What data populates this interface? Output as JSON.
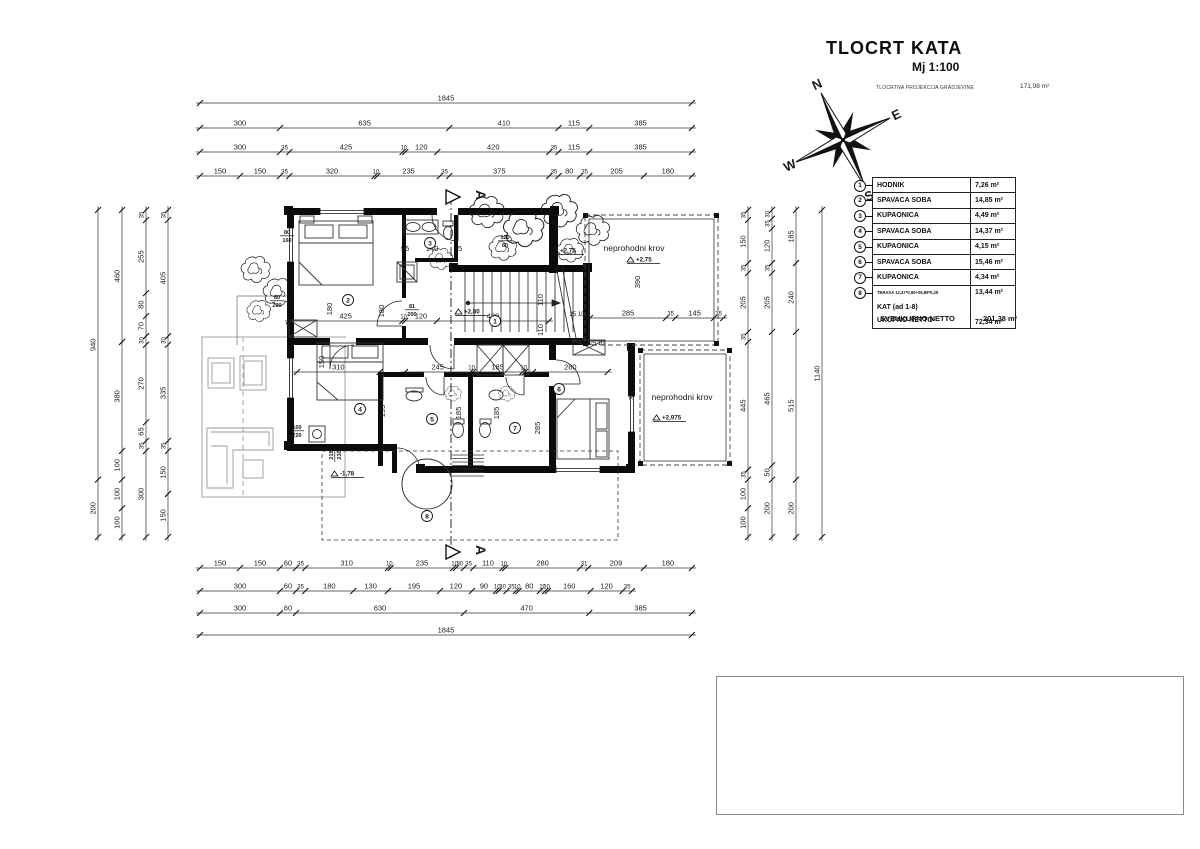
{
  "title_block": {
    "title": "TLOCRT KATA",
    "scale": "Mj 1:100",
    "projection_label": "TLOCRTNA PROJEKCIJA GRADJEVINE",
    "projection_value": "171,98 m²"
  },
  "compass": {
    "n": "N",
    "e": "E",
    "s": "S",
    "w": "W"
  },
  "legend": {
    "rows": [
      {
        "num": "1",
        "label": "HODNIK",
        "value": "7,26 m²",
        "small": false
      },
      {
        "num": "2",
        "label": "SPAVAĆA SOBA",
        "value": "14,85 m²",
        "small": false
      },
      {
        "num": "3",
        "label": "KUPAONICA",
        "value": "4,49 m²",
        "small": false
      },
      {
        "num": "4",
        "label": "SPAVAĆA SOBA",
        "value": "14,37 m²",
        "small": false
      },
      {
        "num": "5",
        "label": "KUPAONICA",
        "value": "4,15 m²",
        "small": false
      },
      {
        "num": "6",
        "label": "SPAVAĆA SOBA",
        "value": "15,46 m²",
        "small": false
      },
      {
        "num": "7",
        "label": "KUPAONICA",
        "value": "4,34 m²",
        "small": false
      },
      {
        "num": "8",
        "label": "TERASA 12,47*0,50+26,89*0,25",
        "value": "13,44 m²",
        "small": true
      }
    ],
    "kat_label": "KAT (ad 1-8)",
    "ukupno_label": "UKUPNO NETTO",
    "ukupno_value": "72,34  m²",
    "total_label": "SVEUKUPNO NETTO",
    "total_value": "201,38  m²"
  },
  "plan": {
    "section_label": "A",
    "roof_label_1": "neprohodni krov",
    "roof_label_2": "neprohodni krov",
    "dim_chains": [
      {
        "dir": "h",
        "x": 200,
        "y": 103,
        "scale": 0.2666,
        "segs": [
          "1845"
        ]
      },
      {
        "dir": "h",
        "x": 200,
        "y": 128,
        "scale": 0.2666,
        "segs": [
          "300",
          "635",
          "410",
          "115",
          "385"
        ]
      },
      {
        "dir": "h",
        "x": 200,
        "y": 152,
        "scale": 0.2666,
        "segs": [
          "300",
          "35",
          "425",
          "10",
          "120",
          "420",
          "35",
          "115",
          "385"
        ]
      },
      {
        "dir": "h",
        "x": 200,
        "y": 176,
        "scale": 0.2666,
        "segs": [
          "150",
          "150",
          "35",
          "320",
          "10",
          "235",
          "35",
          "375",
          "35",
          "80",
          "35",
          "205",
          "180"
        ]
      },
      {
        "dir": "h",
        "x": 200,
        "y": 568,
        "scale": 0.2666,
        "segs": [
          "150",
          "150",
          "60",
          "35",
          "310",
          "10",
          "235",
          "10",
          "30",
          "35",
          "110",
          "10",
          "280",
          "31",
          "209",
          "180"
        ]
      },
      {
        "dir": "h",
        "x": 200,
        "y": 591,
        "scale": 0.2666,
        "segs": [
          "300",
          "60",
          "35",
          "180",
          "130",
          "195",
          "120",
          "90",
          "10",
          "30",
          "35",
          "10",
          "80",
          "20",
          "10",
          "160",
          "120",
          "35"
        ]
      },
      {
        "dir": "h",
        "x": 200,
        "y": 613,
        "scale": 0.2666,
        "segs": [
          "300",
          "60",
          "630",
          "470",
          "385"
        ]
      },
      {
        "dir": "h",
        "x": 200,
        "y": 635,
        "scale": 0.2666,
        "segs": [
          "1845"
        ]
      },
      {
        "dir": "v",
        "x": 98,
        "y": 210,
        "scale": 0.2868,
        "segs": [
          "940",
          "200"
        ]
      },
      {
        "dir": "v",
        "x": 122,
        "y": 210,
        "scale": 0.2868,
        "segs": [
          "460",
          "380",
          "100",
          "100",
          "100"
        ]
      },
      {
        "dir": "v",
        "x": 146,
        "y": 210,
        "scale": 0.2868,
        "segs": [
          "35",
          "255",
          "80",
          "70",
          "30",
          "270",
          "65",
          "35",
          "300"
        ]
      },
      {
        "dir": "v",
        "x": 168,
        "y": 210,
        "scale": 0.2868,
        "segs": [
          "35",
          "405",
          "30",
          "335",
          "35",
          "150",
          "150"
        ]
      },
      {
        "dir": "v",
        "x": 748,
        "y": 210,
        "scale": 0.2868,
        "segs": [
          "35",
          "150",
          "35",
          "205",
          "35",
          "445",
          "35",
          "100",
          "100"
        ]
      },
      {
        "dir": "v",
        "x": 772,
        "y": 210,
        "scale": 0.2868,
        "segs": [
          "30",
          "35",
          "120",
          "35",
          "205",
          "465",
          "50",
          "200"
        ]
      },
      {
        "dir": "v",
        "x": 796,
        "y": 210,
        "scale": 0.2868,
        "segs": [
          "185",
          "240",
          "515",
          "200"
        ]
      },
      {
        "dir": "v",
        "x": 822,
        "y": 210,
        "scale": 0.2868,
        "segs": [
          "1140"
        ]
      },
      {
        "dir": "h",
        "x": 289,
        "y": 321,
        "scale": 0.2666,
        "segs": [
          "425",
          "10",
          "120",
          "420"
        ]
      },
      {
        "dir": "h",
        "x": 590,
        "y": 318,
        "scale": 0.2666,
        "segs": [
          "285",
          "35",
          "145",
          "35"
        ]
      },
      {
        "dir": "h",
        "x": 297,
        "y": 372,
        "scale": 0.2666,
        "segs": [
          "310"
        ]
      },
      {
        "dir": "h",
        "x": 405,
        "y": 372,
        "scale": 0.2666,
        "segs": [
          "245",
          "10",
          "185",
          "10"
        ]
      },
      {
        "dir": "h",
        "x": 533,
        "y": 372,
        "scale": 0.2666,
        "segs": [
          "280"
        ]
      }
    ],
    "texts": [
      {
        "t": "110",
        "x": 543,
        "y": 300,
        "rot": -90
      },
      {
        "t": "110",
        "x": 543,
        "y": 330,
        "rot": -90
      },
      {
        "t": "285",
        "x": 540,
        "y": 428,
        "rot": -90
      },
      {
        "t": "185",
        "x": 461,
        "y": 413,
        "rot": -90
      },
      {
        "t": "185",
        "x": 499,
        "y": 413,
        "rot": -90
      },
      {
        "t": "195",
        "x": 385,
        "y": 411,
        "rot": -90
      },
      {
        "t": "180",
        "x": 384,
        "y": 311,
        "rot": -90
      },
      {
        "t": "180",
        "x": 332,
        "y": 309,
        "rot": -90
      },
      {
        "t": "150",
        "x": 324,
        "y": 362,
        "rot": -90
      },
      {
        "t": "390",
        "x": 640,
        "y": 282,
        "rot": -90
      },
      {
        "t": "395",
        "x": 634,
        "y": 394,
        "rot": -90
      },
      {
        "t": "95",
        "x": 405,
        "y": 251
      },
      {
        "t": "140",
        "x": 432,
        "y": 251
      },
      {
        "t": "25",
        "x": 458,
        "y": 251
      },
      {
        "t": "25 10",
        "x": 577,
        "y": 316,
        "size": 6
      },
      {
        "t": "25 10",
        "x": 597,
        "y": 345,
        "size": 6
      }
    ],
    "levels": [
      {
        "t": "+2,80",
        "x": 466,
        "y": 314
      },
      {
        "t": "+2,75",
        "x": 562,
        "y": 253
      },
      {
        "t": "+2,75",
        "x": 638,
        "y": 262
      },
      {
        "t": "+2,975",
        "x": 664,
        "y": 420
      },
      {
        "t": "-1,78",
        "x": 342,
        "y": 476
      }
    ],
    "stacked": [
      {
        "t1": "80",
        "t2": "160",
        "x": 287,
        "y": 234
      },
      {
        "t1": "80",
        "t2": "220",
        "x": 277,
        "y": 299
      },
      {
        "t1": "81",
        "t2": "200",
        "x": 412,
        "y": 308
      },
      {
        "t1": "100",
        "t2": "220",
        "x": 297,
        "y": 429
      },
      {
        "t1": "120",
        "t2": "60",
        "x": 505,
        "y": 239
      },
      {
        "t1": "215",
        "t2": "230",
        "x": 333,
        "y": 455,
        "rot": -90
      }
    ],
    "rooms": [
      {
        "n": "1",
        "x": 495,
        "y": 321
      },
      {
        "n": "2",
        "x": 348,
        "y": 300
      },
      {
        "n": "3",
        "x": 430,
        "y": 243
      },
      {
        "n": "4",
        "x": 360,
        "y": 409
      },
      {
        "n": "5",
        "x": 432,
        "y": 419
      },
      {
        "n": "6",
        "x": 559,
        "y": 389
      },
      {
        "n": "7",
        "x": 515,
        "y": 428
      },
      {
        "n": "8",
        "x": 427,
        "y": 516
      }
    ]
  }
}
